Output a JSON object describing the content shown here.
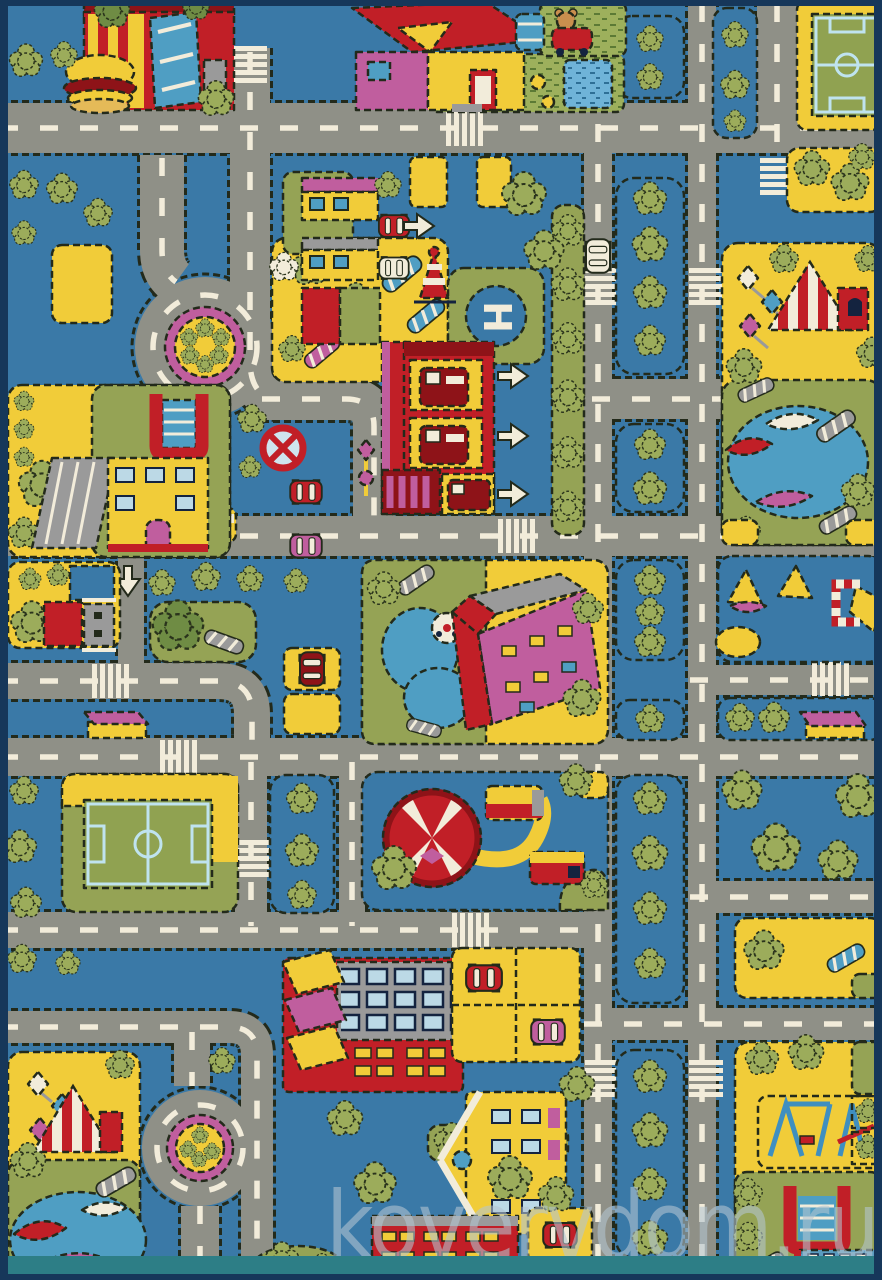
{
  "watermark": {
    "text": "kovervdom.ru"
  },
  "labels": {
    "helipad": "H"
  },
  "palette": {
    "background_blue": "#3a79a7",
    "road_gray": "#8f9087",
    "marking_cream": "#f2ecda",
    "block_yellow": "#f1cc39",
    "block_green": "#95a355",
    "tree_green": "#9cac5b",
    "red": "#c11f27",
    "dark_red": "#8e1318",
    "magenta": "#c05e9e",
    "water_blue": "#4f9ec3",
    "field_line_blue": "#bfe3ef",
    "stitch_outline": "#232a1b",
    "border_teal": "#2d7e86",
    "border_navy": "#16375a",
    "watermark_gray": "#b4c6d2"
  },
  "scene": {
    "subject": "children's city-roads play rug (top view)",
    "elements": [
      "burger-restaurant",
      "farm-house",
      "teddy-bear",
      "soccer-field-top-right",
      "soccer-field-bottom-left",
      "roundabout-top",
      "roundabout-bottom",
      "helipad",
      "fire-station",
      "gas-station",
      "school-left",
      "school-bottom-right",
      "circus-tent",
      "amusement-park",
      "boating-ponds",
      "apartment-building",
      "parking-lots",
      "tree-lined-boulevard",
      "crosswalks",
      "no-entry-sign",
      "direction-arrows",
      "cars",
      "playgrounds",
      "bus-shelters"
    ]
  }
}
